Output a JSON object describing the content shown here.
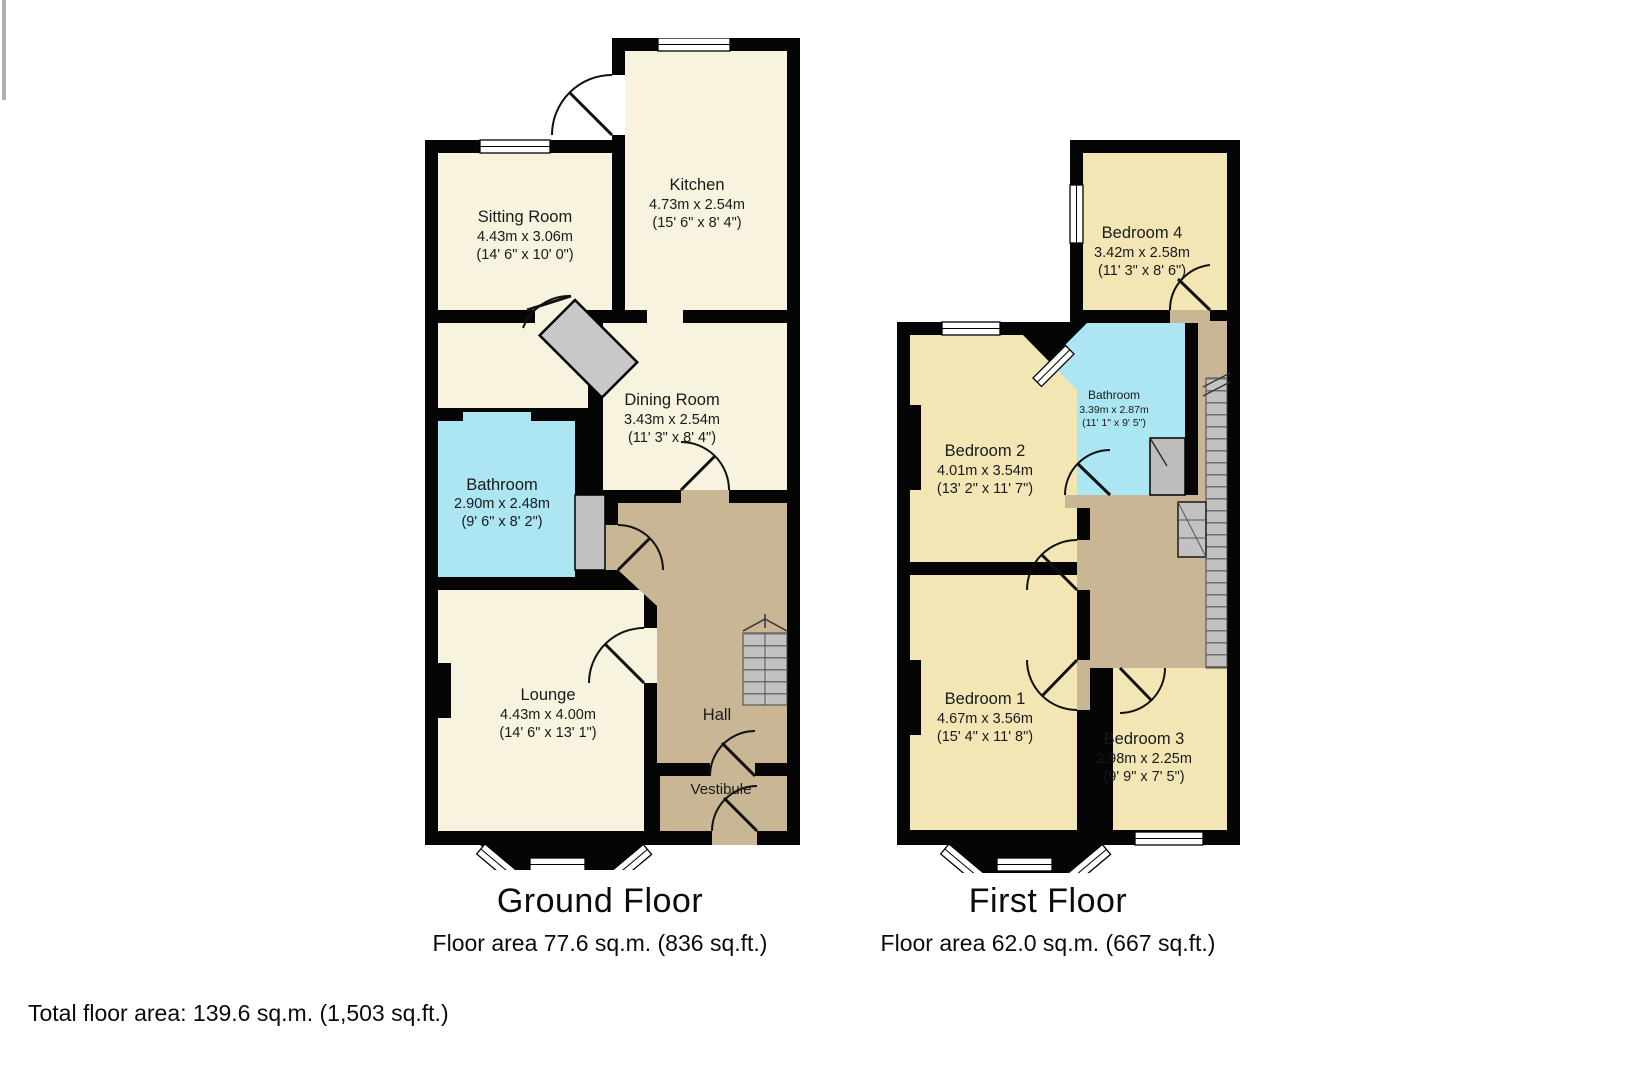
{
  "ground_floor": {
    "title": "Ground Floor",
    "area": "Floor area 77.6 sq.m. (836 sq.ft.)",
    "rooms": {
      "sitting_room": {
        "name": "Sitting Room",
        "metric": "4.43m x 3.06m",
        "imperial": "(14' 6\" x 10' 0\")"
      },
      "kitchen": {
        "name": "Kitchen",
        "metric": "4.73m x 2.54m",
        "imperial": "(15' 6\" x 8' 4\")"
      },
      "dining_room": {
        "name": "Dining Room",
        "metric": "3.43m x 2.54m",
        "imperial": "(11' 3\" x 8' 4\")"
      },
      "bathroom": {
        "name": "Bathroom",
        "metric": "2.90m x 2.48m",
        "imperial": "(9' 6\" x 8' 2\")"
      },
      "lounge": {
        "name": "Lounge",
        "metric": "4.43m x 4.00m",
        "imperial": "(14' 6\" x 13' 1\")"
      },
      "hall": {
        "name": "Hall"
      },
      "vestibule": {
        "name": "Vestibule"
      }
    }
  },
  "first_floor": {
    "title": "First Floor",
    "area": "Floor area 62.0 sq.m. (667 sq.ft.)",
    "rooms": {
      "bedroom_4": {
        "name": "Bedroom 4",
        "metric": "3.42m x 2.58m",
        "imperial": "(11' 3\" x 8' 6\")"
      },
      "bathroom": {
        "name": "Bathroom",
        "metric": "3.39m x 2.87m",
        "imperial": "(11' 1\" x 9' 5\")"
      },
      "bedroom_2": {
        "name": "Bedroom 2",
        "metric": "4.01m x 3.54m",
        "imperial": "(13' 2\" x 11' 7\")"
      },
      "bedroom_1": {
        "name": "Bedroom 1",
        "metric": "4.67m x 3.56m",
        "imperial": "(15' 4\" x 11' 8\")"
      },
      "bedroom_3": {
        "name": "Bedroom 3",
        "metric": "2.98m x 2.25m",
        "imperial": "(9' 9\" x 7' 5\")"
      }
    }
  },
  "footer": {
    "total": "Total floor area: 139.6 sq.m. (1,503 sq.ft.)"
  },
  "colors": {
    "wall": "#050505",
    "ground_room": "#F7F3DF",
    "bedroom": "#F2E7B4",
    "bathroom": "#ABE6F2",
    "hall": "#C8B695",
    "stairs": "#C2C2C2"
  }
}
